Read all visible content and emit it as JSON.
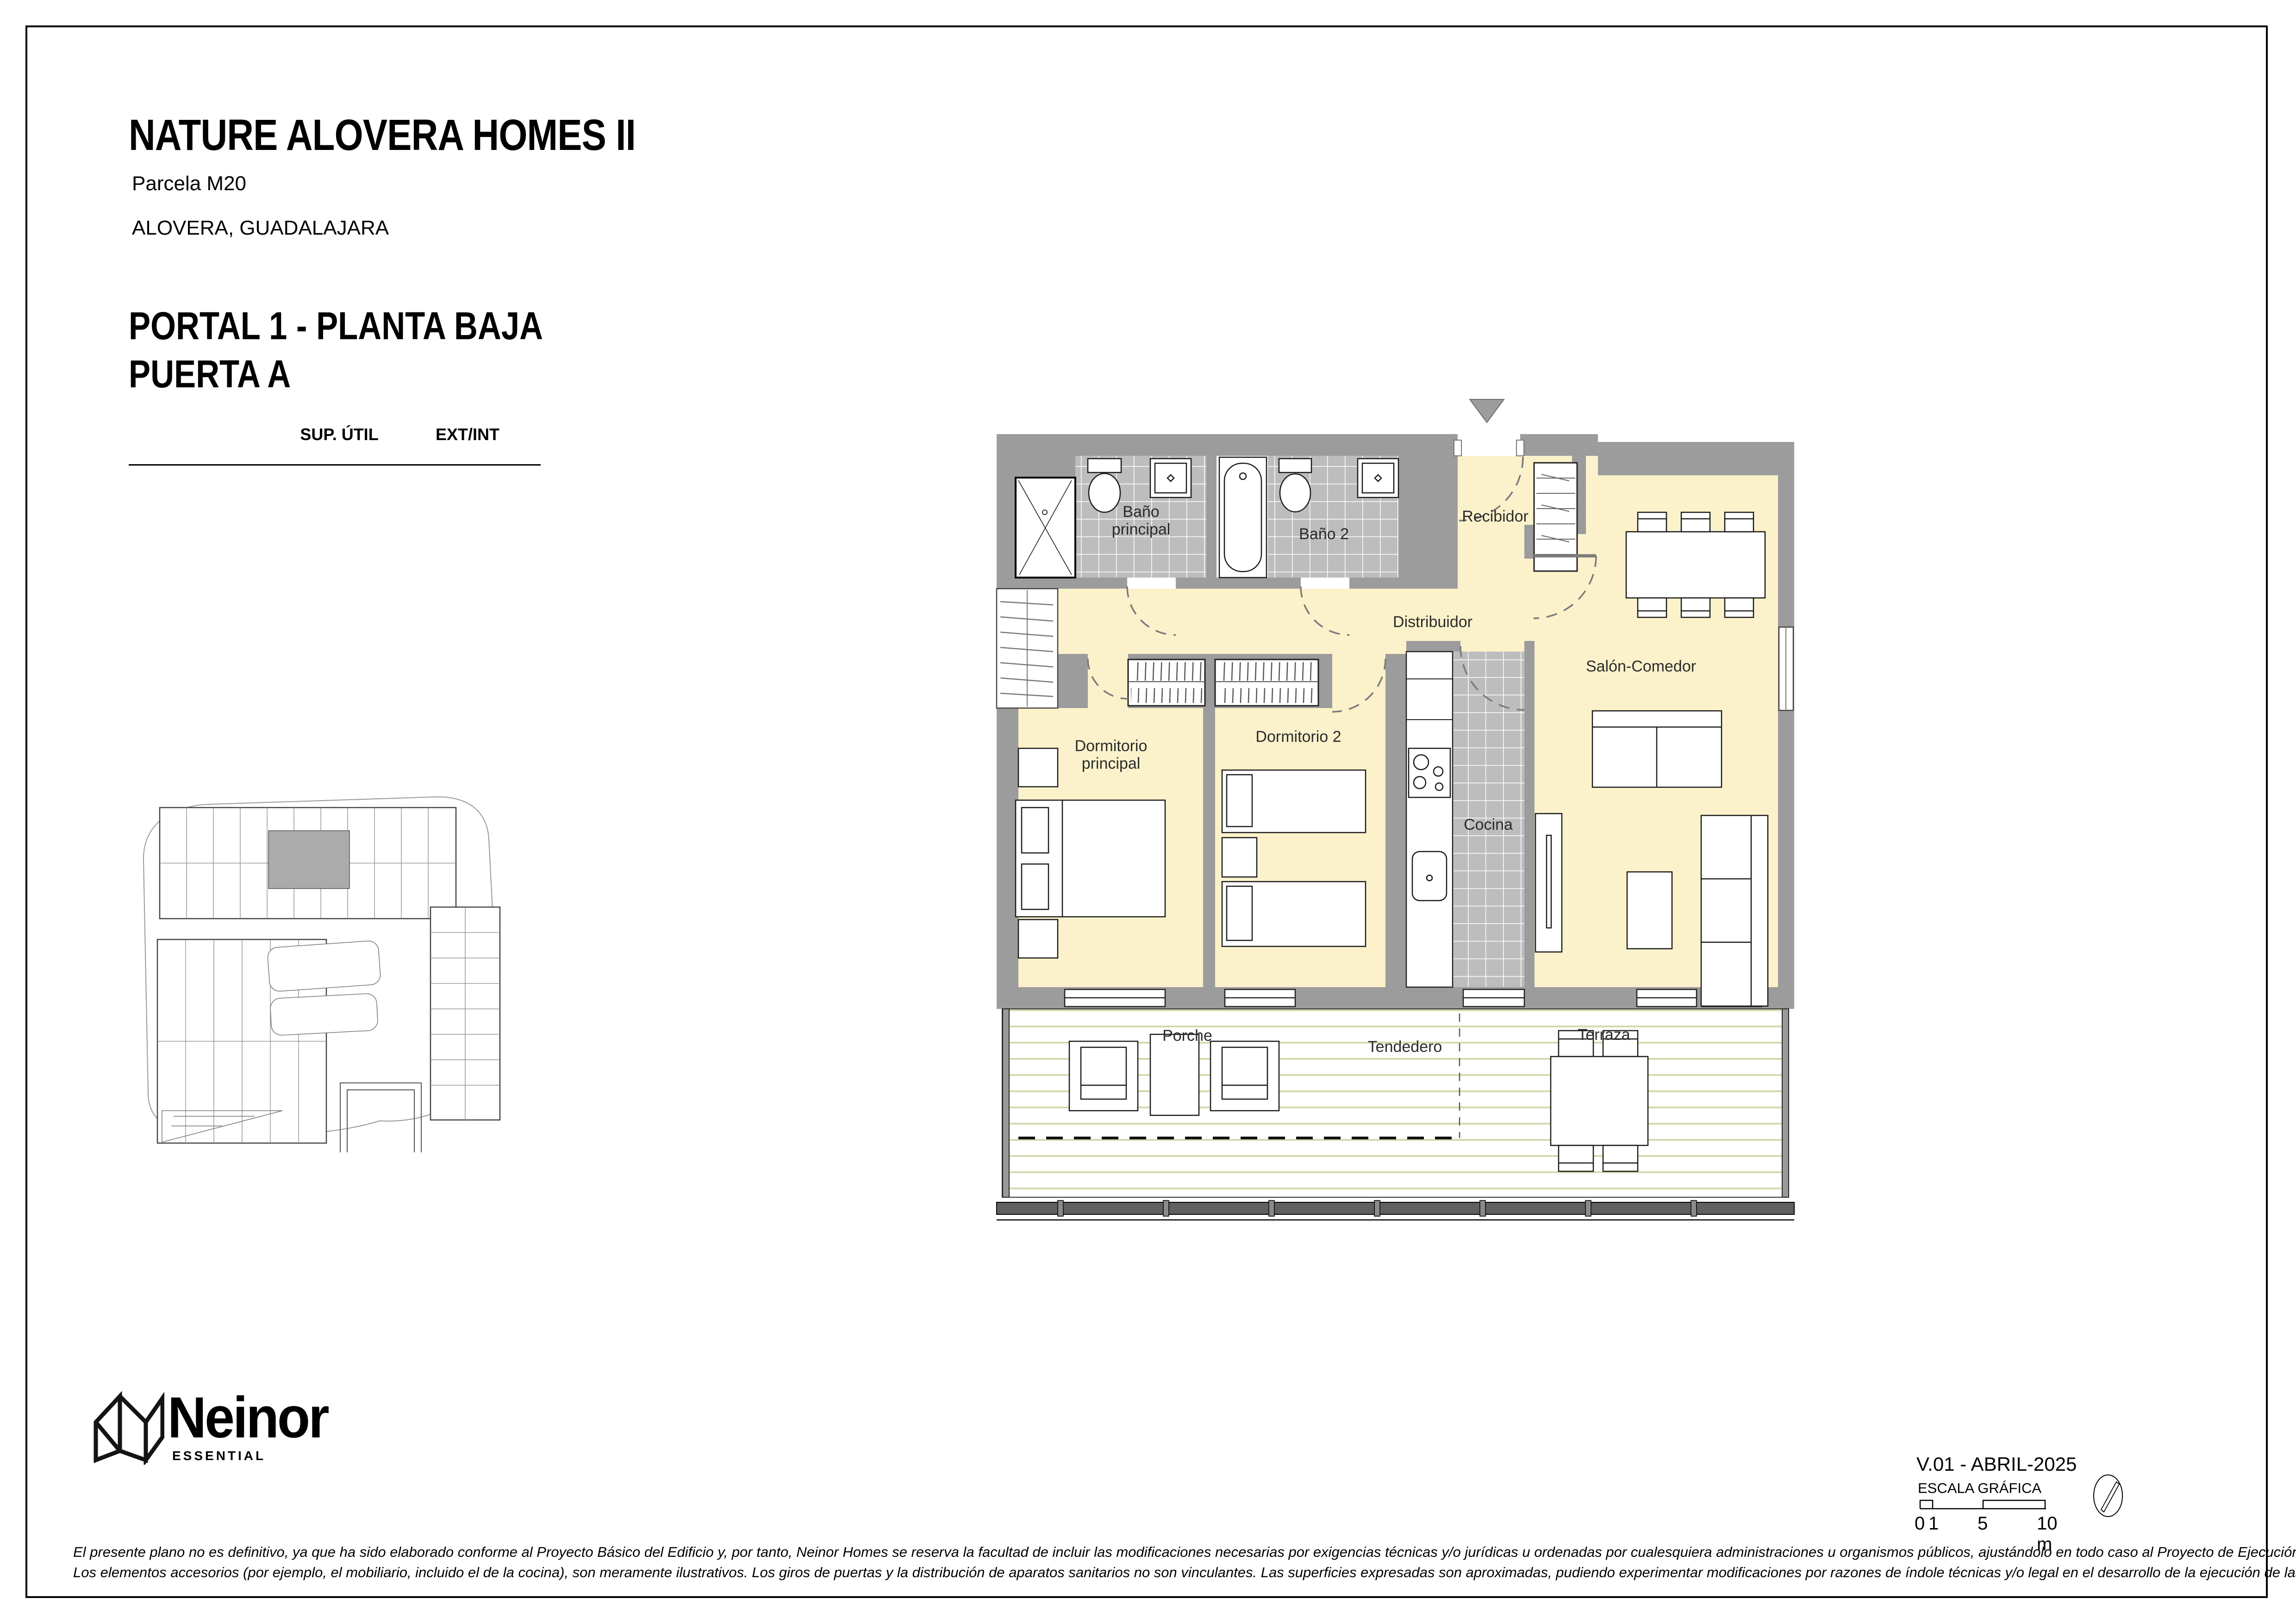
{
  "header": {
    "project_title": "NATURE ALOVERA HOMES II",
    "parcel": "Parcela M20",
    "location": "ALOVERA, GUADALAJARA"
  },
  "unit": {
    "portal_line": "PORTAL 1 - PLANTA BAJA",
    "door_line": "PUERTA A"
  },
  "areas_table": {
    "header_area": "SUP. ÚTIL",
    "header_extint": "EXT/INT",
    "rows": [
      {
        "name": "Recibidor",
        "area": "4.02 m²",
        "type": "int."
      },
      {
        "name": "Salón-Comedor",
        "area": "21.51 m²",
        "type": "int."
      },
      {
        "name": "Cocina",
        "area": "7.28 m²",
        "type": "int."
      },
      {
        "name": "Dormitorio principal",
        "area": "14.88 m²",
        "type": "int."
      },
      {
        "name": "Dormitorio 2",
        "area": "10.76 m²",
        "type": "int."
      },
      {
        "name": "Baño principal",
        "area": "4.13 m²",
        "type": "int."
      },
      {
        "name": "Baño 2",
        "area": "4.20 m²",
        "type": "int."
      },
      {
        "name": "Distribuidor",
        "area": "1.99 m²",
        "type": "int."
      },
      {
        "name": "Tendedero",
        "area": "2.50 m²",
        "type": "ext."
      },
      {
        "name": "Terraza",
        "area": "14.05 m²",
        "type": "ext."
      },
      {
        "name": "Porche",
        "area": "8.37 m²",
        "type": "ext."
      }
    ]
  },
  "summary": {
    "rows": [
      {
        "label": "Superficie Útil Interior",
        "value": "68.77",
        "unit": "m²"
      },
      {
        "label": "Superficie Útil Exterior",
        "value": "24.92",
        "unit": "m²"
      },
      {
        "label": "Superficie Construida con p.p. zc.",
        "value": "89.67",
        "unit": "m²"
      }
    ]
  },
  "plan": {
    "labels": {
      "bano_principal_l1": "Baño",
      "bano_principal_l2": "principal",
      "bano_2": "Baño 2",
      "recibidor": "Recibidor",
      "distribuidor": "Distribuidor",
      "dormitorio_principal_l1": "Dormitorio",
      "dormitorio_principal_l2": "principal",
      "dormitorio_2": "Dormitorio 2",
      "cocina": "Cocina",
      "salon_comedor": "Salón-Comedor",
      "porche": "Porche",
      "tendedero": "Tendedero",
      "terraza": "Terraza"
    }
  },
  "brand": {
    "name": "Neinor",
    "tagline": "ESSENTIAL"
  },
  "title_block": {
    "version": "V.01 - ABRIL-2025",
    "scale_label": "ESCALA GRÁFICA",
    "scale_ticks": [
      "0",
      "1",
      "5",
      "10 m"
    ]
  },
  "footer": {
    "disclaimer_line1": "El presente plano no es definitivo, ya que ha sido elaborado conforme al Proyecto Básico del Edificio y, por tanto, Neinor Homes se reserva la facultad de incluir las modificaciones necesarias por exigencias técnicas y/o jurídicas u ordenadas por cualesquiera administraciones u organismos públicos, ajustándolo en todo caso al Proyecto de Ejecución.",
    "disclaimer_line2": "Los elementos accesorios (por ejemplo, el mobiliario, incluido el de la cocina), son meramente ilustrativos. Los giros de puertas y la distribución de aparatos sanitarios no son vinculantes. Las superficies expresadas son aproximadas, pudiendo experimentar modificaciones por razones de índole técnicas y/o legal en el desarrollo de la ejecución de las obras."
  },
  "colors": {
    "floor_cream": "#FBF2CB",
    "tile_gray": "#BDBDBD",
    "wall_gray": "#9C9C9C",
    "deck_line": "#D8D8AE",
    "railing": "#606060"
  }
}
